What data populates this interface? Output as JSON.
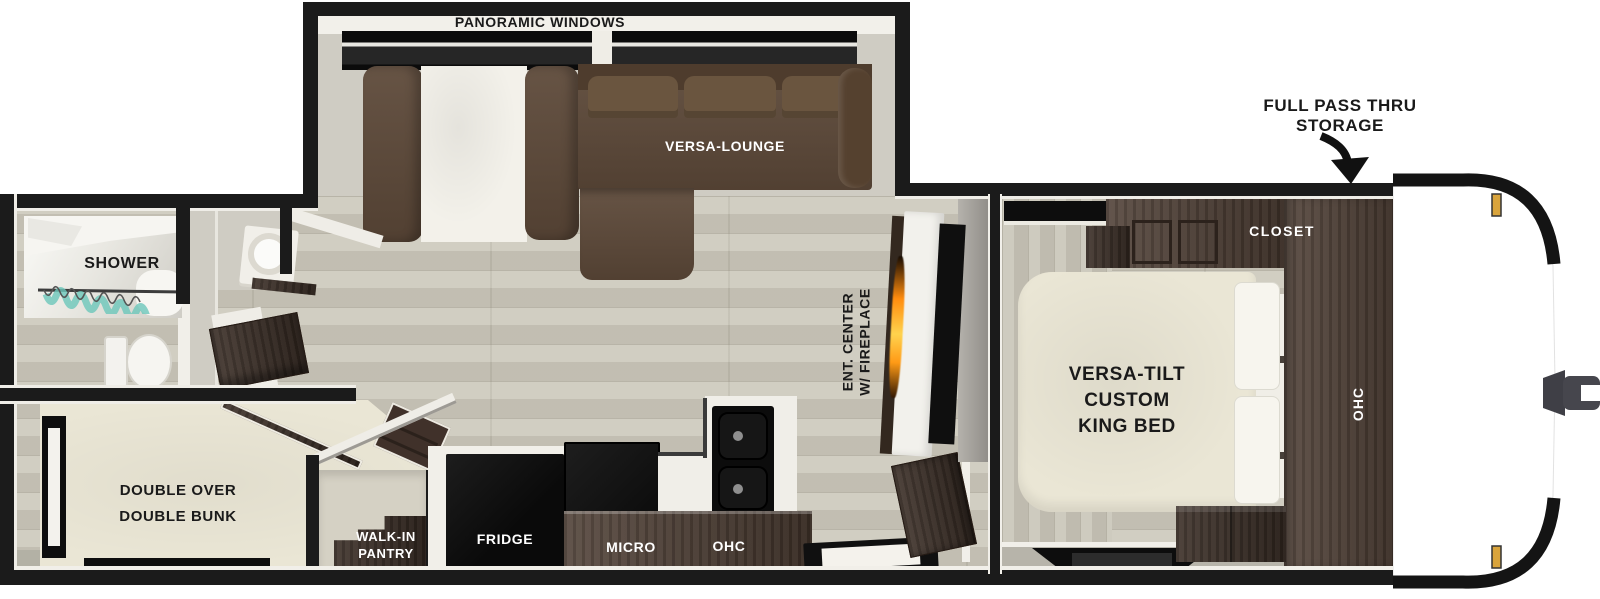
{
  "title": "Travel trailer floor plan",
  "labels": {
    "panoramic_windows": "PANORAMIC WINDOWS",
    "versa_lounge": "VERSA-LOUNGE",
    "pass_thru": {
      "line1": "FULL PASS THRU",
      "line2": "STORAGE"
    },
    "closet": "CLOSET",
    "bedroom_ohc": "OHC",
    "king_bed": {
      "line1": "VERSA-TILT",
      "line2": "CUSTOM",
      "line3": "KING BED"
    },
    "ent_center": {
      "line1": "ENT. CENTER",
      "line2": "W/ FIREPLACE"
    },
    "shower": "SHOWER",
    "bunk": {
      "line1": "DOUBLE OVER",
      "line2": "DOUBLE BUNK"
    },
    "pantry": {
      "line1": "WALK-IN",
      "line2": "PANTRY"
    },
    "fridge": "FRIDGE",
    "micro": "MICRO",
    "kitchen_ohc": "OHC"
  },
  "colors": {
    "wall": "#1b1b1b",
    "floor": "#ccc8bb",
    "cabinet_wood": "#4a3a30",
    "sofa_brown": "#5d4939",
    "bed_cream": "#eae6d5",
    "fireplace_flame": "#ff9b16",
    "curtain_teal": "#6cc7ba",
    "clearance_light_gold": "#d9a43c",
    "front_cap": "#ffffff"
  }
}
